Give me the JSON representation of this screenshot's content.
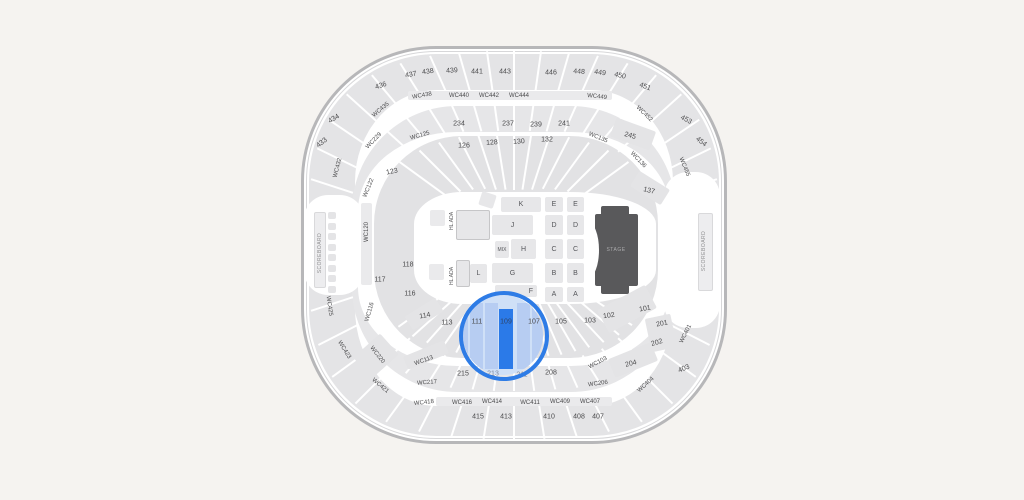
{
  "map": {
    "selected_section": "109",
    "colors": {
      "background": "#f5f3f0",
      "wall": "#b7b7b9",
      "section_gray": "#e4e4e6",
      "highlight_ring": "#2e7ce6",
      "highlight_fill": "#cfe0f7",
      "highlight_column": "#b7cdf2",
      "selected_bar": "#2b7ae8",
      "stage_fill": "#59595b"
    },
    "labels": [
      [
        "437",
        411,
        75,
        -12,
        "num"
      ],
      [
        "438",
        428,
        72,
        -8,
        "num"
      ],
      [
        "439",
        452,
        71,
        -4,
        "num"
      ],
      [
        "441",
        477,
        72,
        0,
        "num"
      ],
      [
        "443",
        505,
        72,
        0,
        "num"
      ],
      [
        "446",
        551,
        73,
        0,
        "num"
      ],
      [
        "448",
        579,
        72,
        4,
        "num"
      ],
      [
        "449",
        600,
        73,
        8,
        "num"
      ],
      [
        "450",
        620,
        76,
        13,
        "num"
      ],
      [
        "451",
        645,
        87,
        20,
        "num"
      ],
      [
        "436",
        381,
        86,
        -18,
        "num"
      ],
      [
        "434",
        334,
        119,
        -30,
        "num"
      ],
      [
        "433",
        322,
        143,
        -38,
        "num"
      ],
      [
        "453",
        686,
        120,
        28,
        "num"
      ],
      [
        "454",
        701,
        142,
        38,
        "num"
      ],
      [
        "403",
        684,
        369,
        -22,
        "num"
      ],
      [
        "415",
        478,
        417,
        0,
        "num"
      ],
      [
        "413",
        506,
        417,
        0,
        "num"
      ],
      [
        "410",
        549,
        417,
        0,
        "num"
      ],
      [
        "408",
        579,
        417,
        0,
        "num"
      ],
      [
        "407",
        598,
        417,
        0,
        "num"
      ],
      [
        "234",
        459,
        124,
        0,
        "num"
      ],
      [
        "237",
        508,
        124,
        0,
        "num"
      ],
      [
        "239",
        536,
        125,
        0,
        "num"
      ],
      [
        "241",
        564,
        124,
        0,
        "num"
      ],
      [
        "245",
        630,
        136,
        16,
        "num"
      ],
      [
        "215",
        463,
        374,
        0,
        "num"
      ],
      [
        "213",
        493,
        374,
        0,
        "dim"
      ],
      [
        "211",
        522,
        375,
        0,
        "dim"
      ],
      [
        "208",
        551,
        373,
        0,
        "num"
      ],
      [
        "204",
        631,
        364,
        -14,
        "num"
      ],
      [
        "202",
        657,
        343,
        -16,
        "num"
      ],
      [
        "201",
        662,
        324,
        -12,
        "num"
      ],
      [
        "123",
        392,
        172,
        -12,
        "num"
      ],
      [
        "126",
        464,
        146,
        0,
        "num"
      ],
      [
        "128",
        492,
        143,
        -4,
        "num"
      ],
      [
        "130",
        519,
        142,
        -4,
        "num"
      ],
      [
        "132",
        547,
        140,
        0,
        "num"
      ],
      [
        "137",
        649,
        191,
        14,
        "num"
      ],
      [
        "118",
        408,
        265,
        0,
        "num"
      ],
      [
        "117",
        380,
        280,
        0,
        "num"
      ],
      [
        "116",
        410,
        294,
        0,
        "num"
      ],
      [
        "114",
        425,
        316,
        -10,
        "num"
      ],
      [
        "113",
        447,
        323,
        0,
        "num"
      ],
      [
        "111",
        477,
        322,
        0,
        "num"
      ],
      [
        "109",
        506,
        322,
        0,
        "sel"
      ],
      [
        "107",
        534,
        322,
        0,
        "num"
      ],
      [
        "105",
        561,
        322,
        0,
        "num"
      ],
      [
        "103",
        590,
        321,
        0,
        "num"
      ],
      [
        "102",
        609,
        316,
        -8,
        "num"
      ],
      [
        "101",
        645,
        309,
        -10,
        "num"
      ],
      [
        "WC438",
        422,
        96,
        -10,
        "wc"
      ],
      [
        "WC440",
        459,
        96,
        0,
        "wc"
      ],
      [
        "WC442",
        489,
        96,
        0,
        "wc"
      ],
      [
        "WC444",
        519,
        96,
        0,
        "wc"
      ],
      [
        "WC449",
        597,
        97,
        6,
        "wc"
      ],
      [
        "WC435",
        381,
        110,
        -40,
        "wc"
      ],
      [
        "WC229",
        374,
        141,
        -46,
        "wc"
      ],
      [
        "WC125",
        420,
        136,
        -16,
        "wc"
      ],
      [
        "WC135",
        598,
        138,
        22,
        "wc"
      ],
      [
        "WC452",
        644,
        114,
        44,
        "wc"
      ],
      [
        "WC455",
        684,
        167,
        68,
        "wc"
      ],
      [
        "WC136",
        638,
        160,
        46,
        "wc"
      ],
      [
        "WC432",
        338,
        168,
        -76,
        "wc"
      ],
      [
        "WC122",
        369,
        188,
        -68,
        "wc"
      ],
      [
        "WC120",
        367,
        232,
        -90,
        "wc"
      ],
      [
        "WC425",
        329,
        306,
        82,
        "wc"
      ],
      [
        "WC423",
        344,
        350,
        58,
        "wc"
      ],
      [
        "WC421",
        380,
        386,
        40,
        "wc"
      ],
      [
        "WC220",
        377,
        355,
        52,
        "wc"
      ],
      [
        "WC116",
        370,
        312,
        -74,
        "wc"
      ],
      [
        "WC113",
        424,
        361,
        -20,
        "wc"
      ],
      [
        "WC217",
        427,
        383,
        -4,
        "wc"
      ],
      [
        "WC418",
        424,
        403,
        -6,
        "wc"
      ],
      [
        "WC416",
        462,
        403,
        0,
        "wc"
      ],
      [
        "WC414",
        492,
        402,
        0,
        "wc"
      ],
      [
        "WC411",
        530,
        403,
        0,
        "wc"
      ],
      [
        "WC409",
        560,
        402,
        0,
        "wc"
      ],
      [
        "WC407",
        590,
        402,
        0,
        "wc"
      ],
      [
        "WC206",
        598,
        384,
        -8,
        "wc"
      ],
      [
        "WC103",
        598,
        363,
        -28,
        "wc"
      ],
      [
        "WC404",
        646,
        385,
        -42,
        "wc"
      ],
      [
        "WC401",
        686,
        334,
        -64,
        "wc"
      ],
      [
        "SCOREBOARD",
        320,
        253,
        -90,
        "sb",
        "scoreboard-label-left"
      ],
      [
        "SCOREBOARD",
        704,
        251,
        -90,
        "sb",
        "scoreboard-label-right"
      ],
      [
        "HL.ADA",
        452,
        221,
        -90,
        "hl",
        "ada-label-upper"
      ],
      [
        "HL.ADA",
        452,
        276,
        -90,
        "hl",
        "ada-label-lower"
      ],
      [
        "STAGE",
        616,
        250,
        0,
        "stg",
        "stage-label"
      ]
    ],
    "blocks": [
      {
        "n": "concourse-left",
        "x": 304,
        "y": 195,
        "w": 60,
        "h": 100,
        "f": "#ffffff",
        "rad": 24
      },
      {
        "n": "concourse-right",
        "x": 664,
        "y": 172,
        "w": 56,
        "h": 156,
        "f": "#ffffff",
        "rad": 24
      },
      {
        "n": "wc-strip-top",
        "x": 408,
        "y": 91,
        "w": 204,
        "h": 9,
        "f": "#eaeaec"
      },
      {
        "n": "wc-strip-bottom",
        "x": 436,
        "y": 397,
        "w": 176,
        "h": 9,
        "f": "#eaeaec"
      },
      {
        "n": "wc120-strip",
        "x": 361,
        "y": 203,
        "w": 11,
        "h": 82,
        "f": "#eaeaec"
      },
      {
        "n": "patch-245",
        "x": 612,
        "y": 124,
        "w": 42,
        "h": 20,
        "f": "#e4e4e6",
        "rot": 20
      },
      {
        "n": "patch-137",
        "x": 632,
        "y": 179,
        "w": 36,
        "h": 18,
        "f": "#e4e4e6",
        "rot": 32
      },
      {
        "n": "patch-101-102",
        "x": 600,
        "y": 296,
        "w": 54,
        "h": 26,
        "f": "#e4e4e6",
        "rot": -28
      },
      {
        "n": "patch-201-202",
        "x": 648,
        "y": 316,
        "w": 26,
        "h": 34,
        "f": "#e4e4e6",
        "rot": -12
      },
      {
        "n": "patch-204",
        "x": 610,
        "y": 350,
        "w": 46,
        "h": 20,
        "f": "#e4e4e6",
        "rot": -22
      },
      {
        "n": "patch-wc220",
        "x": 362,
        "y": 338,
        "w": 28,
        "h": 36,
        "f": "#e4e4e6",
        "rot": 48
      },
      {
        "n": "patch-wc113",
        "x": 404,
        "y": 348,
        "w": 44,
        "h": 14,
        "f": "#e4e4e6",
        "rot": -22
      },
      {
        "n": "patch-114",
        "x": 406,
        "y": 306,
        "w": 36,
        "h": 16,
        "f": "#e4e4e6",
        "rot": -32
      },
      {
        "n": "scoreboard-left-bar",
        "x": 314,
        "y": 212,
        "w": 10,
        "h": 74,
        "f": "#ededef",
        "bd": "#d9d9db"
      },
      {
        "n": "scoreboard-right-bar",
        "x": 698,
        "y": 213,
        "w": 13,
        "h": 76,
        "f": "#ededef",
        "bd": "#d9d9db"
      },
      {
        "n": "stage",
        "x": 595,
        "y": 214,
        "w": 43,
        "h": 72,
        "f": "#59595b"
      },
      {
        "n": "stage-tab-top",
        "x": 601,
        "y": 206,
        "w": 28,
        "h": 10,
        "f": "#59595b"
      },
      {
        "n": "stage-tab-bottom",
        "x": 601,
        "y": 284,
        "w": 28,
        "h": 10,
        "f": "#59595b"
      },
      {
        "n": "stage-notch",
        "x": 577,
        "y": 222,
        "w": 22,
        "h": 56,
        "f": "#ffffff",
        "ellipse": 1
      },
      {
        "n": "ada-box-upper",
        "x": 456,
        "y": 210,
        "w": 32,
        "h": 28,
        "f": "#e7e7e9",
        "bd": "#c6c6c8"
      },
      {
        "n": "ada-box-lower",
        "x": 456,
        "y": 260,
        "w": 12,
        "h": 25,
        "f": "#e7e7e9",
        "bd": "#c6c6c8"
      },
      {
        "n": "ada-square-upper",
        "x": 430,
        "y": 210,
        "w": 15,
        "h": 16,
        "f": "#eaeaec"
      },
      {
        "n": "ada-square-lower",
        "x": 429,
        "y": 264,
        "w": 15,
        "h": 16,
        "f": "#eaeaec"
      },
      {
        "n": "tilt-box",
        "x": 480,
        "y": 193,
        "w": 15,
        "h": 14,
        "f": "#e7e7e9",
        "rot": 18
      },
      {
        "n": "floor-K",
        "x": 501,
        "y": 197,
        "w": 40,
        "h": 15,
        "lab": "K",
        "i": 1
      },
      {
        "n": "floor-J",
        "x": 492,
        "y": 215,
        "w": 41,
        "h": 20,
        "lab": "J",
        "i": 1
      },
      {
        "n": "floor-MIX",
        "x": 495,
        "y": 241,
        "w": 14,
        "h": 17,
        "lab": "MIX",
        "small": 1,
        "i": 1
      },
      {
        "n": "floor-H",
        "x": 511,
        "y": 239,
        "w": 25,
        "h": 20,
        "lab": "H",
        "i": 1
      },
      {
        "n": "floor-L",
        "x": 470,
        "y": 264,
        "w": 17,
        "h": 19,
        "lab": "L",
        "i": 1
      },
      {
        "n": "floor-G",
        "x": 492,
        "y": 263,
        "w": 41,
        "h": 20,
        "lab": "G",
        "i": 1
      },
      {
        "n": "floor-F",
        "x": 495,
        "y": 285,
        "w": 42,
        "h": 12,
        "lab": "F",
        "alignR": 1,
        "i": 1
      },
      {
        "n": "floor-E-1",
        "x": 545,
        "y": 197,
        "w": 18,
        "h": 15,
        "lab": "E",
        "i": 1
      },
      {
        "n": "floor-E-2",
        "x": 567,
        "y": 197,
        "w": 17,
        "h": 15,
        "lab": "E",
        "i": 1
      },
      {
        "n": "floor-D-1",
        "x": 545,
        "y": 215,
        "w": 18,
        "h": 20,
        "lab": "D",
        "i": 1
      },
      {
        "n": "floor-D-2",
        "x": 567,
        "y": 215,
        "w": 17,
        "h": 20,
        "lab": "D",
        "i": 1
      },
      {
        "n": "floor-C-1",
        "x": 545,
        "y": 239,
        "w": 18,
        "h": 20,
        "lab": "C",
        "i": 1
      },
      {
        "n": "floor-C-2",
        "x": 567,
        "y": 239,
        "w": 17,
        "h": 20,
        "lab": "C",
        "i": 1
      },
      {
        "n": "floor-B-1",
        "x": 545,
        "y": 263,
        "w": 18,
        "h": 20,
        "lab": "B",
        "i": 1
      },
      {
        "n": "floor-B-2",
        "x": 567,
        "y": 263,
        "w": 17,
        "h": 20,
        "lab": "B",
        "i": 1
      },
      {
        "n": "floor-A-1",
        "x": 545,
        "y": 287,
        "w": 18,
        "h": 15,
        "lab": "A",
        "i": 1
      },
      {
        "n": "floor-A-2",
        "x": 567,
        "y": 287,
        "w": 17,
        "h": 15,
        "lab": "A",
        "i": 1
      }
    ],
    "scoreboard_segments": {
      "x": 328,
      "y": 212,
      "count": 8,
      "step": 10.5,
      "w": 8,
      "h": 7,
      "fill": "#e4e4e6"
    },
    "highlight": {
      "section": "109",
      "ring_color": "#2e7ce6",
      "fill": "#cfe0f7",
      "column_fill": "#b7cdf2",
      "bar_color": "#2b7ae8",
      "circle": {
        "x": 463,
        "y": 295,
        "d": 80
      },
      "ring": {
        "x": 459,
        "y": 291,
        "d": 82,
        "stroke": 4
      },
      "columns": [
        [
          -8,
          8,
          13,
          64
        ],
        [
          7,
          8,
          13,
          66
        ],
        [
          22,
          8,
          13,
          66
        ],
        [
          54,
          8,
          13,
          66
        ],
        [
          69,
          8,
          13,
          64
        ]
      ],
      "bar": [
        36,
        14,
        14,
        60
      ]
    }
  }
}
